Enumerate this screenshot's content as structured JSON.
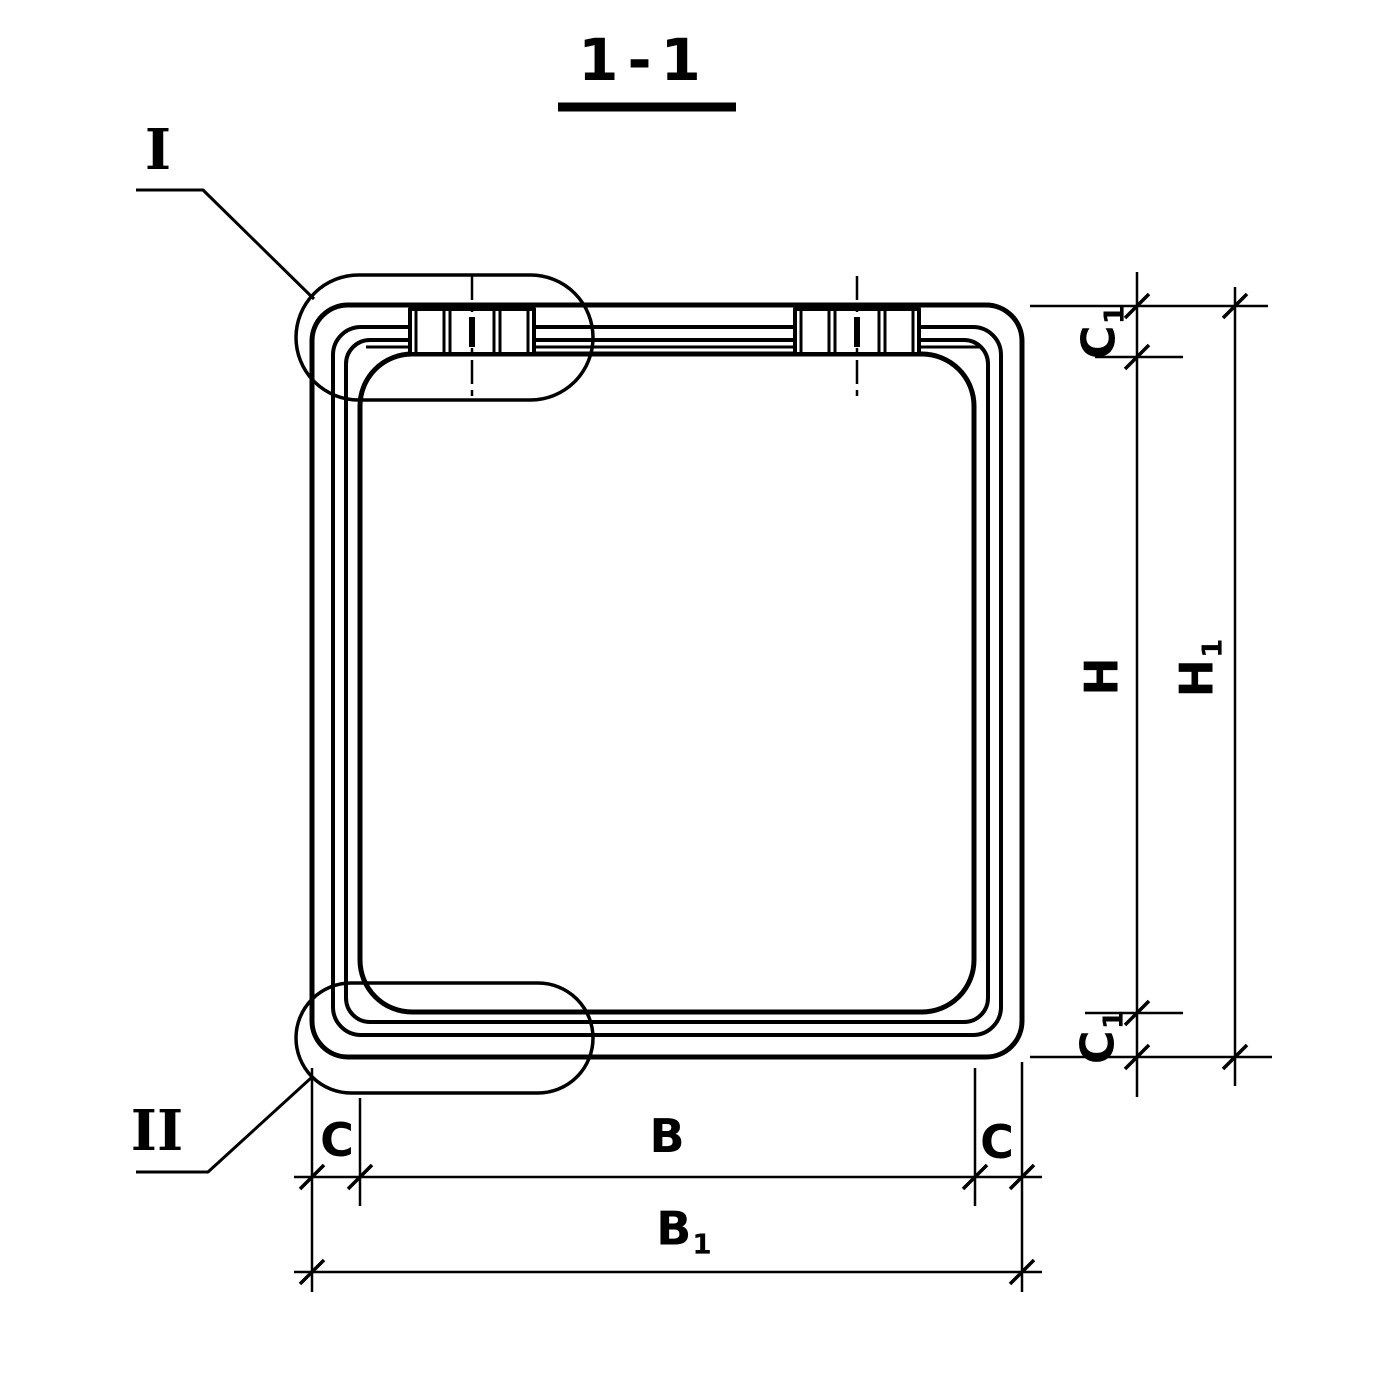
{
  "drawing": {
    "title": "1-1",
    "details": {
      "top_left": "I",
      "bottom_left": "II"
    }
  },
  "dims": {
    "c1_top": {
      "main": "C",
      "sub": "1"
    },
    "h": {
      "main": "H",
      "sub": ""
    },
    "h1": {
      "main": "H",
      "sub": "1"
    },
    "c1_bottom": {
      "main": "C",
      "sub": "1"
    },
    "c_left": {
      "main": "C",
      "sub": ""
    },
    "b": {
      "main": "B",
      "sub": ""
    },
    "c_right": {
      "main": "C",
      "sub": ""
    },
    "b1": {
      "main": "B",
      "sub": "1"
    }
  },
  "style": {
    "line_color": "#000000",
    "background_color": "#ffffff"
  }
}
